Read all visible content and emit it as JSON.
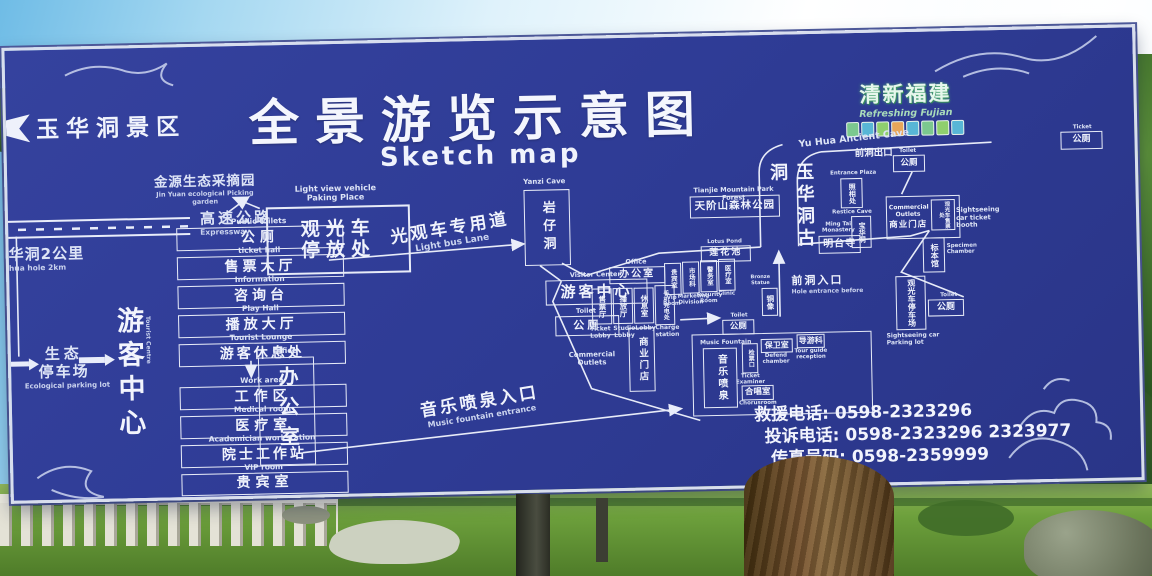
{
  "colors": {
    "board_blue": "#2f3c96",
    "line_white": "#e9edfa",
    "logo_green": "#8fd4a8"
  },
  "board": {
    "scenic_area": "玉华洞景区",
    "title": "全景游览示意图",
    "subtitle": "Sketch map"
  },
  "logo": {
    "cn": "清新福建",
    "en": "Refreshing Fujian",
    "badge_colors": [
      "#7bc88f",
      "#58b6d6",
      "#8fcf6e",
      "#e8a65a",
      "#58b6d6",
      "#7bc88f",
      "#8fcf6e",
      "#58b6d6"
    ]
  },
  "left": {
    "garden": {
      "cn": "金源生态采摘园",
      "en": "Jin Yuan ecological Picking garden"
    },
    "expressway": {
      "cn": "高速公路",
      "en": "Expressway"
    },
    "distance": {
      "cn": "华洞2公里",
      "en": "hua hole 2km"
    },
    "eco_parking": {
      "cn_line1": "生态",
      "cn_line2": "停车场",
      "en": "Ecological parking lot"
    },
    "tourist_centre": {
      "cn": "游客中心",
      "en": "Tourist Centre"
    },
    "facilities": [
      {
        "en": "Public toilets",
        "cn": "公厕"
      },
      {
        "en": "ticket hall",
        "cn": "售票大厅"
      },
      {
        "en": "Information",
        "cn": "咨询台"
      },
      {
        "en": "Play Hall",
        "cn": "播放大厅"
      },
      {
        "en": "Tourist Lounge",
        "cn": "游客休息处"
      },
      {
        "en": "Work area",
        "cn": "工作区"
      },
      {
        "en": "Medical room",
        "cn": "医疗室"
      },
      {
        "en": "Academician workstation",
        "cn": "院士工作站"
      },
      {
        "en": "VIP room",
        "cn": "贵宾室"
      }
    ],
    "office": {
      "en": "Office",
      "cn": "办公室"
    }
  },
  "center": {
    "parking_place": {
      "en_line1": "Light view vehicle",
      "en_line2": "Paking Place",
      "cn_line1": "观光车",
      "cn_line2": "停放处"
    },
    "bus_lane": {
      "cn": "光观车专用道",
      "en": "Light bus Lane"
    },
    "yanzi": {
      "en": "Yanzi Cave",
      "cn": "岩仔洞"
    },
    "visitor_center": {
      "en": "Visitor Center",
      "cn": "游客中心"
    },
    "toilet": {
      "en": "Toilet",
      "cn": "公厕"
    },
    "office": {
      "en": "Office",
      "cn": "办公室"
    },
    "rooms": [
      {
        "cn": "售票厅",
        "en": "Ticket Lobby"
      },
      {
        "cn": "播放厅",
        "en": "Studio Lobby"
      },
      {
        "cn": "休息室",
        "en": "Lobby"
      },
      {
        "cn": "手机充电处",
        "en": "Charge station"
      }
    ],
    "dept_rooms": [
      {
        "cn": "贵宾室",
        "en": "Vip Room"
      },
      {
        "cn": "市场科",
        "en": "Marketing Division"
      },
      {
        "cn": "警务室",
        "en": "Security Room"
      },
      {
        "cn": "医疗室",
        "en": "Clinic"
      }
    ],
    "commercial": {
      "en": "Commercial Outlets",
      "cn": "商业门店"
    }
  },
  "right": {
    "ancient_cave_label": "Yu Hua Ancient Cave",
    "corridor": "玉华洞古洞",
    "forest_park": {
      "en": "Tianjie Mountain Park Forest",
      "cn": "天阶山森林公园"
    },
    "lotus_pond": {
      "en": "Lotus Pond",
      "cn": "莲花池"
    },
    "ming_tai": {
      "en": "Ming Tai Monastery",
      "cn": "明台寺"
    },
    "front_exit": "前洞出口",
    "toilet_top": {
      "en": "Toilet",
      "cn": "公厕"
    },
    "ticket_toilet": {
      "en": "Ticket",
      "cn": "公厕"
    },
    "entrance_photo": {
      "en": "Entrance Plaza",
      "cn": "照相处"
    },
    "restice_cave": {
      "en": "Restice Cave",
      "cn": "宝华洞"
    },
    "commercial": {
      "en": "Commercial Outlets",
      "cn": "商业门店"
    },
    "car_ticket": {
      "cn": "观光车售票处",
      "en": "Sightseeing car ticket booth"
    },
    "specimen": {
      "cn": "标本馆",
      "en": "Specimen Chamber"
    },
    "car_parking": {
      "cn": "观光车停车场",
      "en": "Sightseeing car Parking lot"
    },
    "toilet_right": {
      "en": "Toilet",
      "cn": "公厕"
    },
    "front_entrance": {
      "cn": "前洞入口",
      "en": "Hole entrance before"
    },
    "bronze": {
      "en": "Bronze Statue",
      "cn": "铜像"
    }
  },
  "fountain": {
    "toilet": {
      "en": "Toilet",
      "cn": "公厕"
    },
    "music_fountain": {
      "en": "Music Fountain",
      "cn": "音乐喷泉"
    },
    "ticket_examiner": {
      "cn": "检票口",
      "en": "Ticket Examiner"
    },
    "defend": {
      "cn": "保卫室",
      "en": "Defend chamber"
    },
    "tour_guide": {
      "cn": "导游科",
      "en": "Tour guide reception"
    },
    "chorus": {
      "cn": "合唱室",
      "en": "Chorusroom"
    },
    "entrance": {
      "cn": "音乐喷泉入口",
      "en": "Music fountain entrance"
    }
  },
  "contacts": {
    "rows": [
      {
        "label": "救援电话:",
        "value": "0598-2323296"
      },
      {
        "label": "投诉电话:",
        "value": "0598-2323296 2323977"
      },
      {
        "label": "传真号码:",
        "value": "0598-2359999"
      }
    ]
  }
}
